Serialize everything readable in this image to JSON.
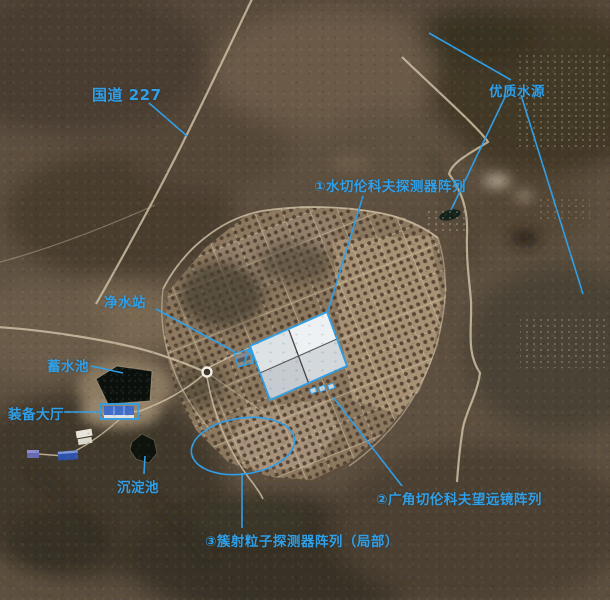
{
  "image": {
    "annotation_color": "#2f9fe8",
    "type_label": "satellite-annotated-view"
  },
  "annotations": {
    "highway": {
      "label": "国道 227"
    },
    "water_source": {
      "label": "优质水源"
    },
    "wcda": {
      "label": "①水切伦科夫探测器阵列"
    },
    "purification": {
      "label": "净水站"
    },
    "reservoir": {
      "label": "蓄水池"
    },
    "equipment_hall": {
      "label": "装备大厅"
    },
    "sedimentation": {
      "label": "沉淀池"
    },
    "wfcta": {
      "label": "②广角切伦科夫望远镜阵列"
    },
    "shower_array": {
      "label": "③簇射粒子探测器阵列（局部）"
    }
  }
}
